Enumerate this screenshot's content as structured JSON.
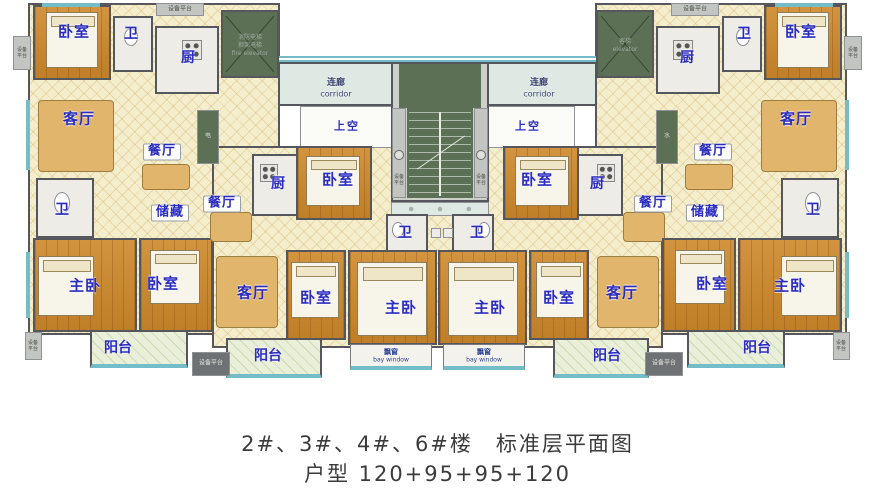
{
  "caption": {
    "line1": "2#、3#、4#、6#楼　标准层平面图",
    "line2": "户型 120+95+95+120"
  },
  "rooms": {
    "bedroom": "卧室",
    "master_bedroom": "主卧",
    "living_room": "客厅",
    "dining_room": "餐厅",
    "kitchen": "厨",
    "bathroom": "卫",
    "storage": "储藏",
    "balcony": "阳台"
  },
  "core": {
    "corridor_cn": "连廊",
    "corridor_en": "corridor",
    "open_above": "上空",
    "bay_window_cn": "飘窗",
    "bay_window_en": "bay window",
    "equipment_platform": "设备平台",
    "fire_elevator": [
      "消防电梯",
      "担架电梯",
      "fire elevator"
    ],
    "passenger_elevator": [
      "客梯",
      "elevator"
    ],
    "electric_shaft": "电",
    "water_shaft": "水"
  },
  "colors": {
    "label_blue": "#2a2cc0",
    "wood_floor": "#c8872f",
    "hatch_cream": "#f5eecd",
    "shaft_green": "#5b7055",
    "window_teal": "#74bdc8",
    "balcony_green": "#e9efd8",
    "caption_gray": "#3b3b3b"
  }
}
